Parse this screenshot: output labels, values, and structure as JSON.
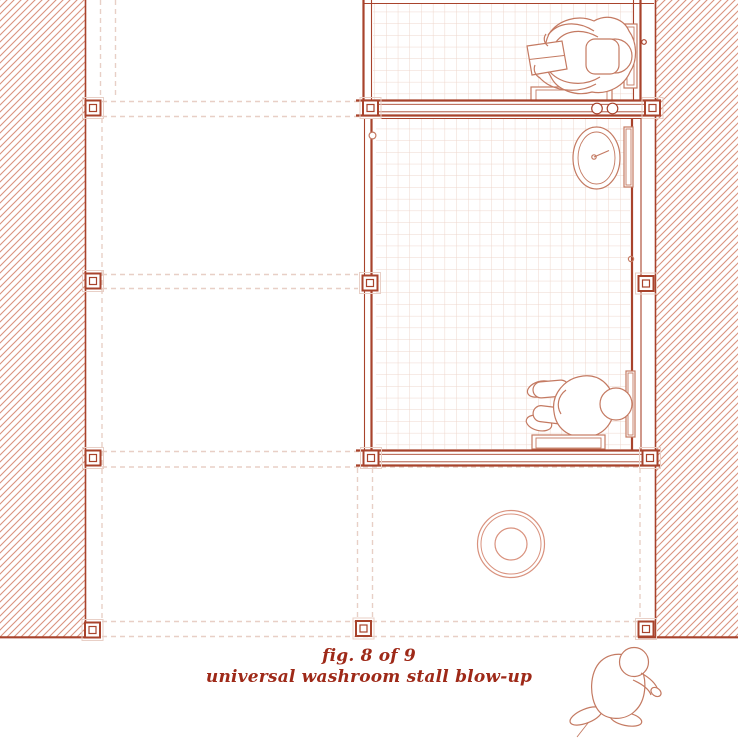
{
  "caption": {
    "line1": "fig. 8 of 9",
    "line2": "universal washroom stall blow-up"
  },
  "colors": {
    "wall": "#a8432c",
    "hatch": "#d9927e",
    "tile": "#eed6cc",
    "dashed": "#e8cfc6",
    "fig": "#c47a62",
    "caption": "#9e2918"
  },
  "drawing": {
    "type": "architectural-plan",
    "elements": [
      "left-wall-section",
      "right-wall-section",
      "upper-stall",
      "universal-stall",
      "structural-grid",
      "column-markers",
      "change-table-person",
      "wash-basin",
      "grab-bar",
      "coat-hook",
      "bench",
      "door-hardware",
      "floor-drain",
      "seated-person",
      "crouching-person"
    ]
  }
}
